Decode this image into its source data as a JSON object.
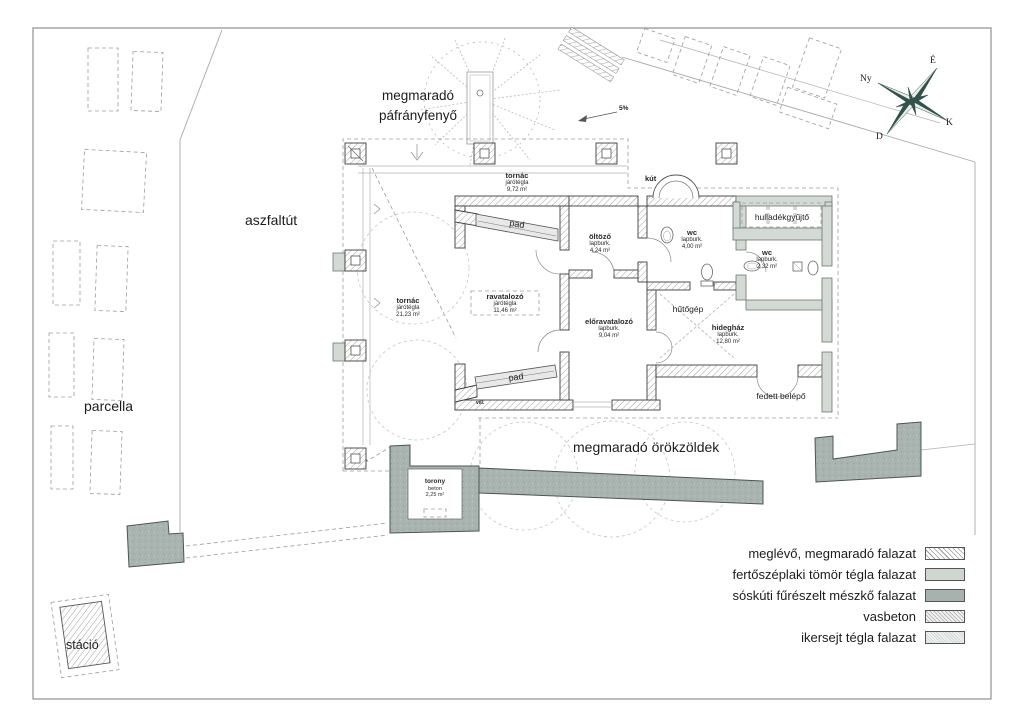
{
  "labels": {
    "pafrany1": "megmaradó",
    "pafrany2": "páfrányfenyő",
    "aszfaltut": "aszfaltút",
    "parcella": "parcella",
    "stacio": "stáció",
    "orokzoldek": "megmaradó örökzöldek",
    "slope": "5%",
    "vill": "vill.",
    "kut": "kút",
    "hulladek": "hulladékgyűjtő",
    "hutogep": "hűtőgép",
    "fedett": "fedett belépő",
    "pad": "pad"
  },
  "compass": {
    "n": "É",
    "e": "K",
    "s": "D",
    "w": "Ny"
  },
  "rooms": {
    "tornac_top": {
      "name": "tornác",
      "mat": "járótégla",
      "area": "9,72 m²"
    },
    "tornac_left": {
      "name": "tornác",
      "mat": "járótégla",
      "area": "21,23 m²"
    },
    "ravatalozo": {
      "name": "ravatalozó",
      "mat": "járótégla",
      "area": "11,46 m²"
    },
    "oltozo": {
      "name": "öltöző",
      "mat": "lapburk.",
      "area": "4,24 m²"
    },
    "wc1": {
      "name": "wc",
      "mat": "lapburk.",
      "area": "4,00 m²"
    },
    "eloravatalozo": {
      "name": "előravatalozó",
      "mat": "lapburk.",
      "area": "9,04 m²"
    },
    "hideghaz": {
      "name": "hidegház",
      "mat": "lapburk.",
      "area": "12,80 m²"
    },
    "wc2": {
      "name": "wc",
      "mat": "lapburk.",
      "area": "2,32 m²"
    },
    "torony": {
      "name": "torony",
      "mat": "beton",
      "area": "2,25 m²"
    }
  },
  "legend": {
    "items": [
      {
        "label": "meglévő, megmaradó falazat"
      },
      {
        "label": "fertőszéplaki tömör tégla falazat"
      },
      {
        "label": "sóskúti fűrészelt mészkő falazat"
      },
      {
        "label": "vasbeton"
      },
      {
        "label": "ikersejt tégla falazat"
      }
    ]
  },
  "colors": {
    "stone": "#a7b2ae",
    "brick": "#d3d9d5",
    "hatch_line": "#9b9b9b",
    "compass_dark": "#33524a"
  }
}
